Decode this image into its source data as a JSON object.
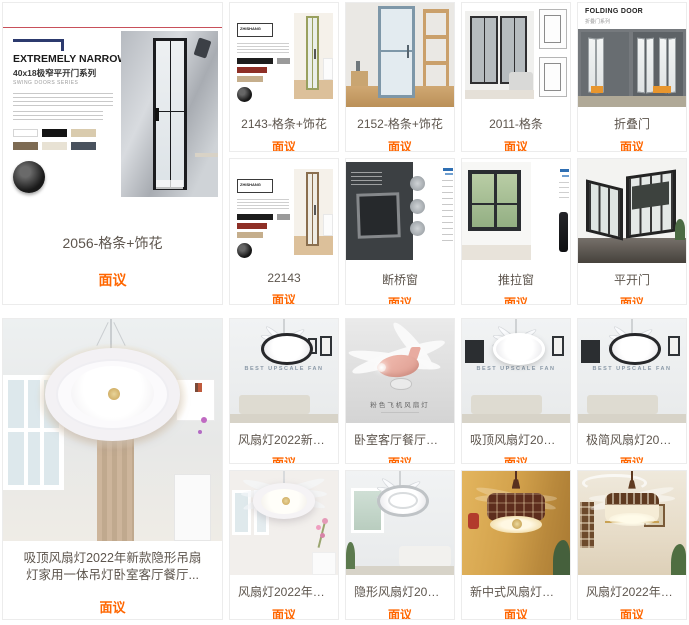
{
  "colors": {
    "price": "#ff6600",
    "title": "#5d554d",
    "accent": "#ff6600"
  },
  "price_label": "面议",
  "top_section": {
    "big_card": {
      "title": "2056-格条+饰花",
      "price": "面议",
      "poster": {
        "headline": "EXTREMELY NARROW",
        "subhead": "40x18极窄平开门系列",
        "series_label": "SWING DOORS SERIES"
      }
    },
    "cards": [
      {
        "title": "2143-格条+饰花",
        "price": "面议",
        "logo": "ZHISHANG"
      },
      {
        "title": "2152-格条+饰花",
        "price": "面议"
      },
      {
        "title": "2011-格条",
        "price": "面议"
      },
      {
        "title": "折叠门",
        "price": "面议",
        "poster_title": "FOLDING DOOR",
        "poster_sub": "折叠门系列"
      },
      {
        "title": "22143",
        "price": "面议",
        "logo": "ZHISHANG"
      },
      {
        "title": "断桥窗",
        "price": "面议"
      },
      {
        "title": "推拉窗",
        "price": "面议"
      },
      {
        "title": "平开门",
        "price": "面议"
      }
    ]
  },
  "bottom_section": {
    "big_card": {
      "title_line1": "吸顶风扇灯2022年新款隐形吊扇",
      "title_line2": "灯家用一体吊灯卧室客厅餐厅...",
      "price": "面议"
    },
    "cards": [
      {
        "title": "风扇灯2022新款约家用餐...",
        "price": "面议",
        "watermark": "BEST UPSCALE FAN"
      },
      {
        "title": "卧室客厅餐厅吸顶风扇灯..",
        "price": "面议",
        "label": "粉色飞机风扇灯"
      },
      {
        "title": "吸顶风扇灯2022年新款隐...",
        "price": "面议",
        "watermark": "BEST UPSCALE FAN"
      },
      {
        "title": "极简风扇灯2022年新款简...",
        "price": "面议",
        "watermark": "BEST UPSCALE FAN"
      },
      {
        "title": "风扇灯2022年新款餐厅卧...",
        "price": "面议"
      },
      {
        "title": "隐形风扇灯2022新款简约...",
        "price": "面议"
      },
      {
        "title": "新中式风扇灯吊灯客厅灯...",
        "price": "面议"
      },
      {
        "title": "风扇灯2022年新款吸顶吊...",
        "price": "面议"
      }
    ]
  }
}
